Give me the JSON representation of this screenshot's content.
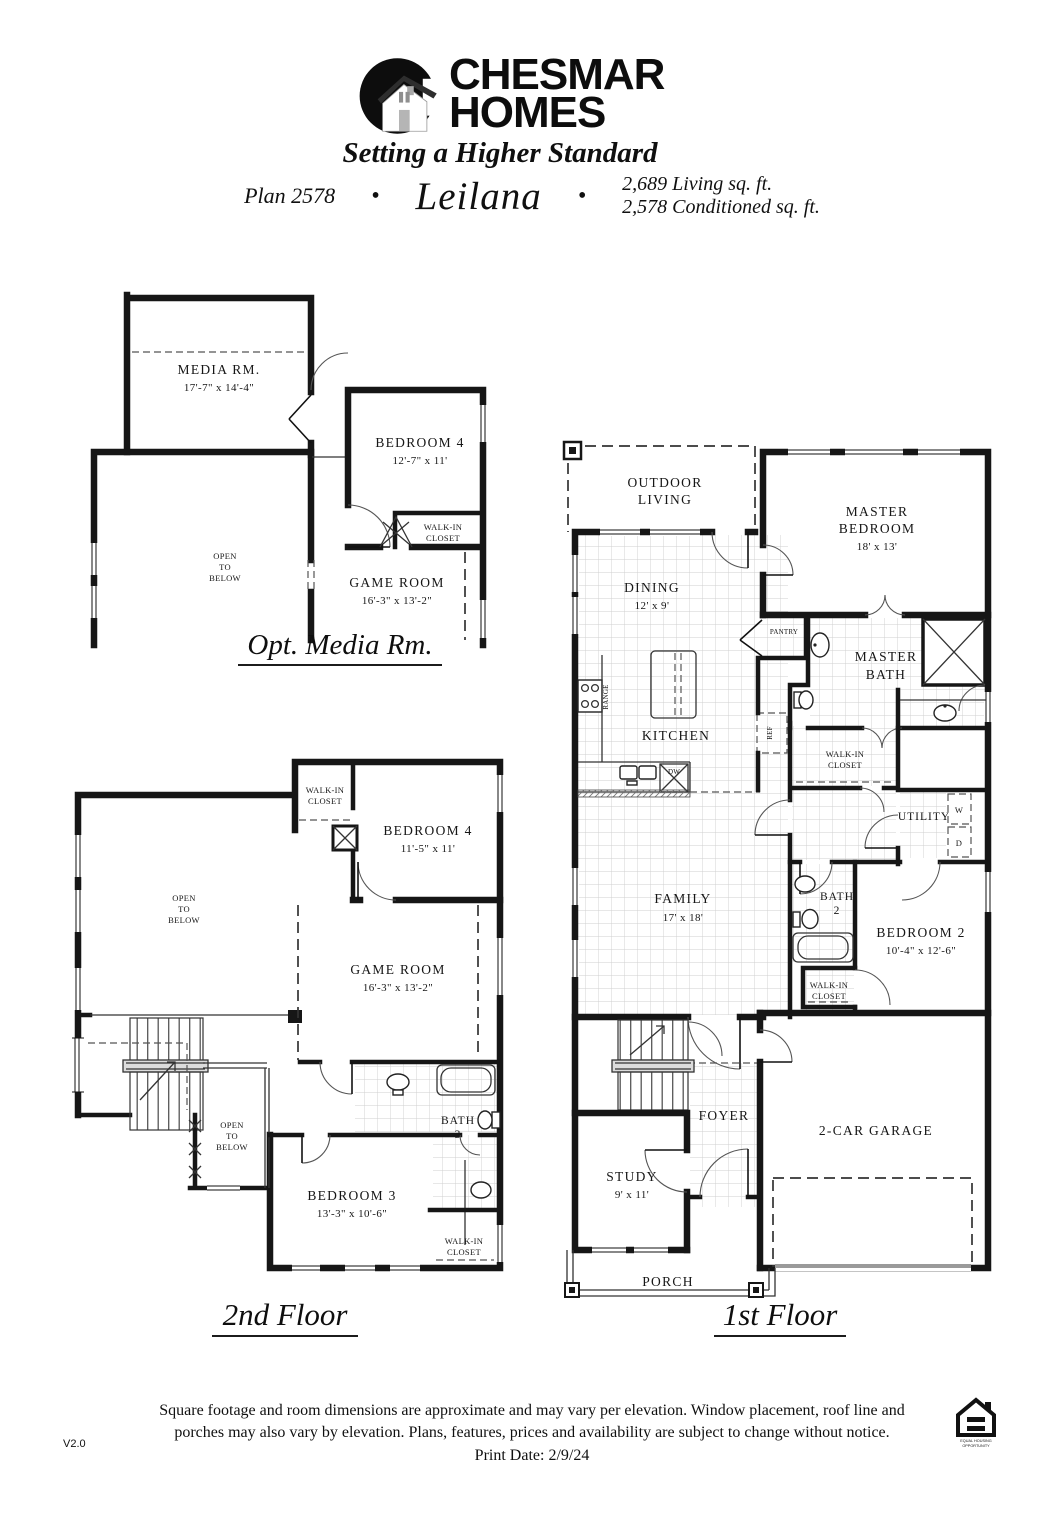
{
  "header": {
    "brand_line1": "CHESMAR",
    "brand_line2": "HOMES",
    "tagline": "Setting a Higher Standard",
    "plan_number": "Plan 2578",
    "bullet": "•",
    "plan_name": "Leilana",
    "living_sqft": "2,689 Living sq. ft.",
    "conditioned_sqft": "2,578 Conditioned sq. ft."
  },
  "common": {
    "walk_in": "WALK-IN",
    "closet": "CLOSET",
    "open": "OPEN",
    "to": "TO",
    "below": "BELOW"
  },
  "opt_media": {
    "title": "Opt. Media Rm.",
    "media_rm": {
      "name": "MEDIA RM.",
      "dims": "17'-7\" x 14'-4\""
    },
    "bedroom4": {
      "name": "BEDROOM 4",
      "dims": "12'-7\" x 11'"
    },
    "game_room": {
      "name": "GAME ROOM",
      "dims": "16'-3\" x 13'-2\""
    }
  },
  "second_floor": {
    "title": "2nd Floor",
    "bedroom4": {
      "name": "BEDROOM 4",
      "dims": "11'-5\" x 11'"
    },
    "game_room": {
      "name": "GAME ROOM",
      "dims": "16'-3\" x 13'-2\""
    },
    "bedroom3": {
      "name": "BEDROOM 3",
      "dims": "13'-3\" x 10'-6\""
    },
    "bath3": {
      "name": "BATH",
      "number": "3"
    }
  },
  "first_floor": {
    "title": "1st Floor",
    "outdoor_living": {
      "l1": "OUTDOOR",
      "l2": "LIVING"
    },
    "master_bedroom": {
      "l1": "MASTER",
      "l2": "BEDROOM",
      "dims": "18' x 13'"
    },
    "dining": {
      "name": "DINING",
      "dims": "12' x 9'"
    },
    "pantry": "PANTRY",
    "master_bath": {
      "l1": "MASTER",
      "l2": "BATH"
    },
    "kitchen": "KITCHEN",
    "range": "RANGE",
    "ref": "REF",
    "dw": "DW",
    "family": {
      "name": "FAMILY",
      "dims": "17' x 18'"
    },
    "utility": {
      "name": "UTILITY",
      "w": "W",
      "d": "D"
    },
    "bath2": {
      "name": "BATH",
      "number": "2"
    },
    "bedroom2": {
      "name": "BEDROOM 2",
      "dims": "10'-4\" x 12'-6\""
    },
    "foyer": "FOYER",
    "study": {
      "name": "STUDY",
      "dims": "9' x 11'"
    },
    "garage": "2-CAR GARAGE",
    "porch": "PORCH"
  },
  "footer": {
    "disclaimer1": "Square footage and room dimensions are approximate and may vary per elevation. Window placement, roof line and",
    "disclaimer2": "porches may also vary by elevation. Plans, features, prices and availability are subject to change without notice.",
    "print_date": "Print Date: 2/9/24",
    "version": "V2.0",
    "eho_l1": "EQUAL HOUSING",
    "eho_l2": "OPPORTUNITY"
  }
}
